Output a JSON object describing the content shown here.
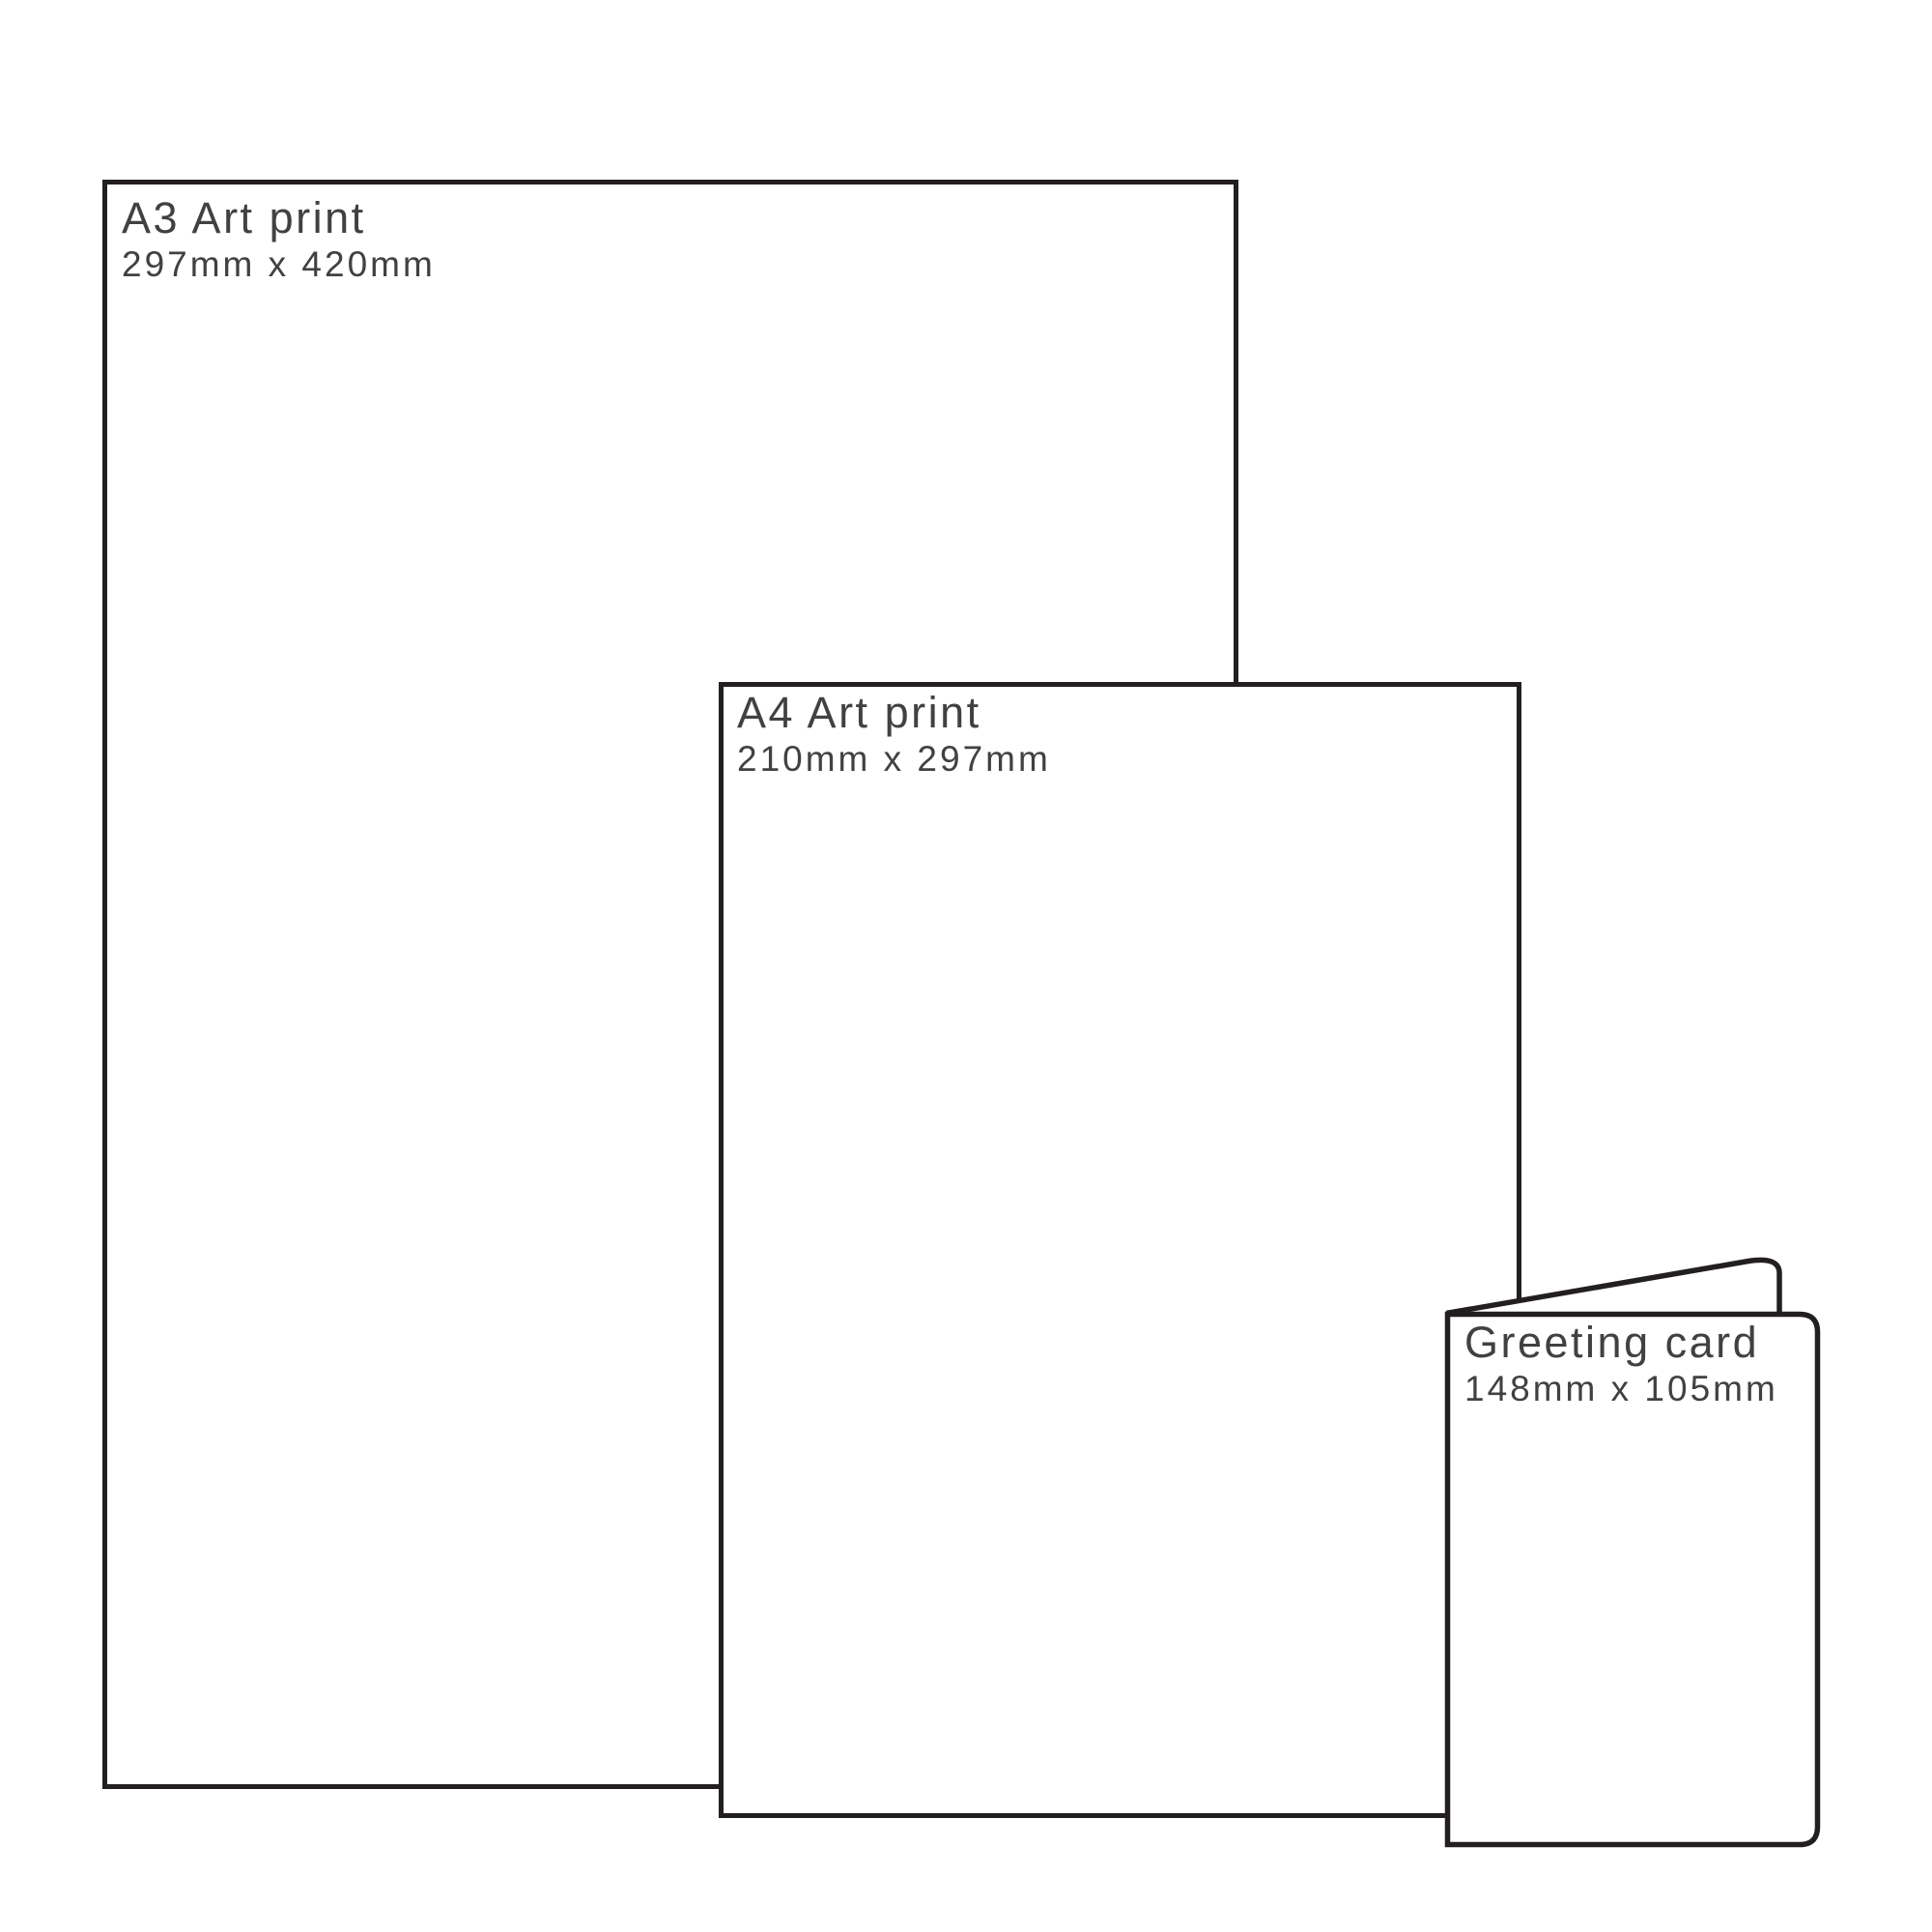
{
  "diagram": {
    "background_color": "#ffffff",
    "outline_color": "#231f20",
    "label_color": "#414042",
    "items": [
      {
        "id": "a3-art-print",
        "title": "A3 Art print",
        "size": "297mm x 420mm"
      },
      {
        "id": "a4-art-print",
        "title": "A4 Art print",
        "size": "210mm x 297mm"
      },
      {
        "id": "greeting-card",
        "title": "Greeting card",
        "size": "148mm x 105mm"
      }
    ]
  }
}
